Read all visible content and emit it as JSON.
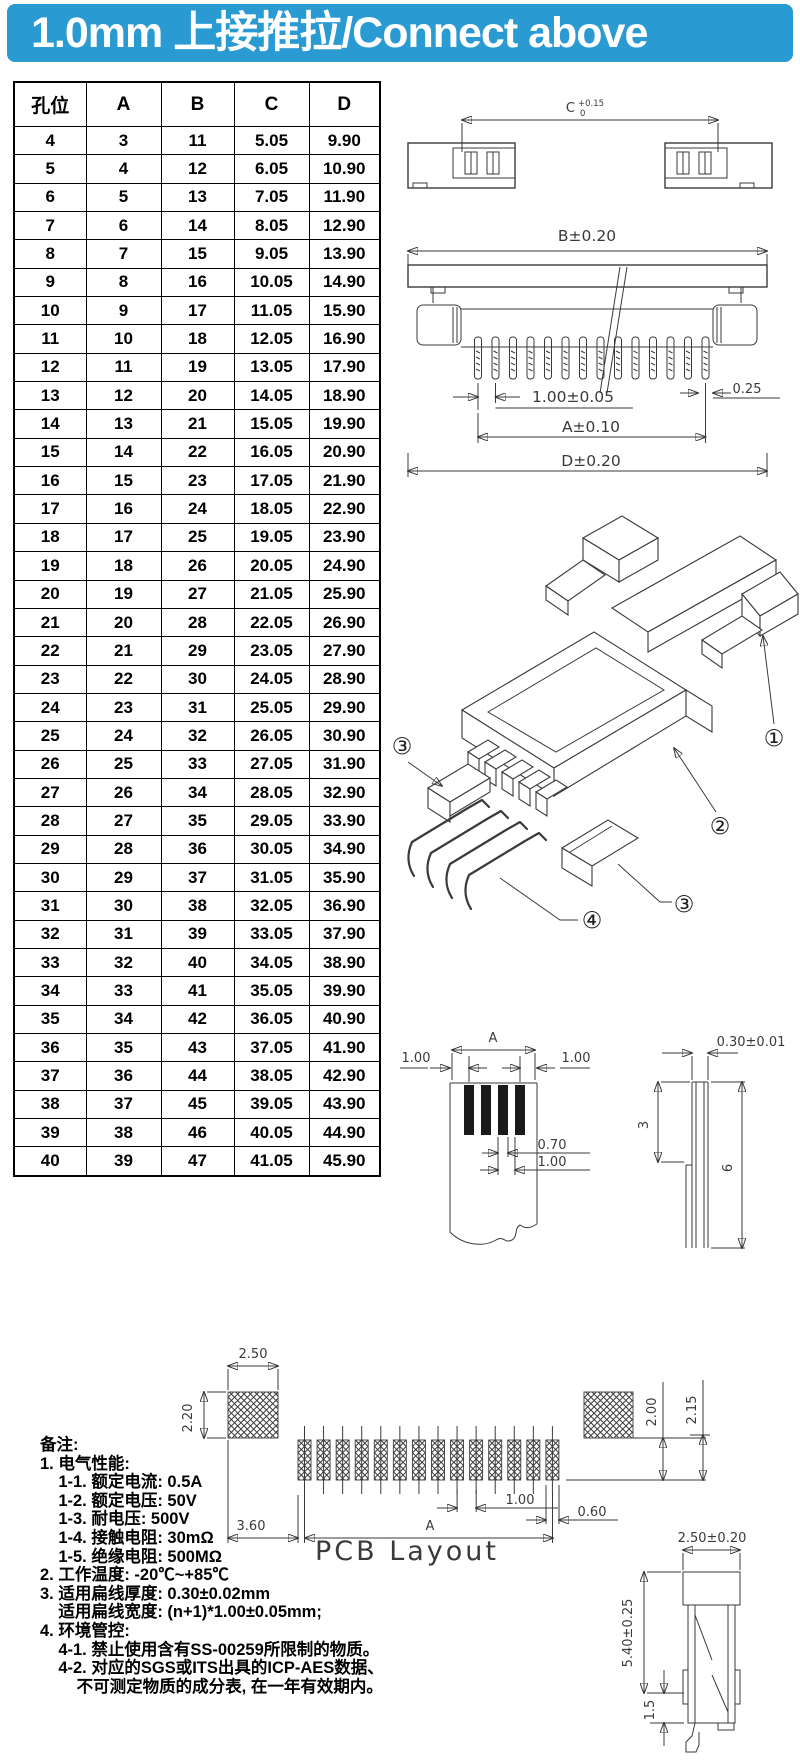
{
  "header": {
    "title": "1.0mm 上接推拉/Connect above"
  },
  "colors": {
    "banner_bg": "#2A9AD2",
    "banner_fg": "#ffffff",
    "line": "#3a3a3a"
  },
  "table": {
    "headers": [
      "孔位",
      "A",
      "B",
      "C",
      "D"
    ],
    "rows": [
      [
        "4",
        "3",
        "11",
        "5.05",
        "9.90"
      ],
      [
        "5",
        "4",
        "12",
        "6.05",
        "10.90"
      ],
      [
        "6",
        "5",
        "13",
        "7.05",
        "11.90"
      ],
      [
        "7",
        "6",
        "14",
        "8.05",
        "12.90"
      ],
      [
        "8",
        "7",
        "15",
        "9.05",
        "13.90"
      ],
      [
        "9",
        "8",
        "16",
        "10.05",
        "14.90"
      ],
      [
        "10",
        "9",
        "17",
        "11.05",
        "15.90"
      ],
      [
        "11",
        "10",
        "18",
        "12.05",
        "16.90"
      ],
      [
        "12",
        "11",
        "19",
        "13.05",
        "17.90"
      ],
      [
        "13",
        "12",
        "20",
        "14.05",
        "18.90"
      ],
      [
        "14",
        "13",
        "21",
        "15.05",
        "19.90"
      ],
      [
        "15",
        "14",
        "22",
        "16.05",
        "20.90"
      ],
      [
        "16",
        "15",
        "23",
        "17.05",
        "21.90"
      ],
      [
        "17",
        "16",
        "24",
        "18.05",
        "22.90"
      ],
      [
        "18",
        "17",
        "25",
        "19.05",
        "23.90"
      ],
      [
        "19",
        "18",
        "26",
        "20.05",
        "24.90"
      ],
      [
        "20",
        "19",
        "27",
        "21.05",
        "25.90"
      ],
      [
        "21",
        "20",
        "28",
        "22.05",
        "26.90"
      ],
      [
        "22",
        "21",
        "29",
        "23.05",
        "27.90"
      ],
      [
        "23",
        "22",
        "30",
        "24.05",
        "28.90"
      ],
      [
        "24",
        "23",
        "31",
        "25.05",
        "29.90"
      ],
      [
        "25",
        "24",
        "32",
        "26.05",
        "30.90"
      ],
      [
        "26",
        "25",
        "33",
        "27.05",
        "31.90"
      ],
      [
        "27",
        "26",
        "34",
        "28.05",
        "32.90"
      ],
      [
        "28",
        "27",
        "35",
        "29.05",
        "33.90"
      ],
      [
        "29",
        "28",
        "36",
        "30.05",
        "34.90"
      ],
      [
        "30",
        "29",
        "37",
        "31.05",
        "35.90"
      ],
      [
        "31",
        "30",
        "38",
        "32.05",
        "36.90"
      ],
      [
        "32",
        "31",
        "39",
        "33.05",
        "37.90"
      ],
      [
        "33",
        "32",
        "40",
        "34.05",
        "38.90"
      ],
      [
        "34",
        "33",
        "41",
        "35.05",
        "39.90"
      ],
      [
        "35",
        "34",
        "42",
        "36.05",
        "40.90"
      ],
      [
        "36",
        "35",
        "43",
        "37.05",
        "41.90"
      ],
      [
        "37",
        "36",
        "44",
        "38.05",
        "42.90"
      ],
      [
        "38",
        "37",
        "45",
        "39.05",
        "43.90"
      ],
      [
        "39",
        "38",
        "46",
        "40.05",
        "44.90"
      ],
      [
        "40",
        "39",
        "47",
        "41.05",
        "45.90"
      ]
    ]
  },
  "drawings": {
    "top_view": {
      "dim_c_base": "C",
      "dim_c_tol_up": "+0.15",
      "dim_c_tol_dn": "0"
    },
    "front_view": {
      "dim_b": "B±0.20",
      "dim_pitch": "1.00±0.05",
      "dim_pin_w": "0.25",
      "dim_a": "A±0.10",
      "dim_d": "D±0.20"
    },
    "exploded": {
      "label_1": "①",
      "label_2": "②",
      "label_3a": "③",
      "label_3b": "③",
      "label_4": "④"
    },
    "ffc_front": {
      "dim_a": "A",
      "dim_margin_left": "1.00",
      "dim_margin_right": "1.00",
      "dim_cond_w": "0.70",
      "dim_pitch": "1.00"
    },
    "ffc_side": {
      "dim_thickness": "0.30±0.01",
      "dim_exposed": "3",
      "dim_total": "6"
    },
    "pcb": {
      "dim_pad_w": "2.50",
      "dim_pad_h": "2.20",
      "dim_edge": "3.60",
      "dim_a": "A",
      "dim_pitch": "1.00",
      "dim_last_w": "0.60",
      "dim_h1": "2.00",
      "dim_h2": "2.15",
      "label": "PCB Layout"
    },
    "side_view": {
      "dim_w": "2.50±0.20",
      "dim_h": "5.40±0.25",
      "dim_lead": "1.5"
    }
  },
  "notes": {
    "lines": [
      "备注:",
      "1. 电气性能:",
      "    1-1. 额定电流: 0.5A",
      "    1-2. 额定电压: 50V",
      "    1-3. 耐电压: 500V",
      "    1-4. 接触电阻: 30mΩ",
      "    1-5. 绝缘电阻: 500MΩ",
      "2. 工作温度: -20℃~+85℃",
      "3. 适用扁线厚度: 0.30±0.02mm",
      "    适用扁线宽度: (n+1)*1.00±0.05mm;",
      "4. 环境管控:",
      "    4-1. 禁止使用含有SS-00259所限制的物质。",
      "    4-2. 对应的SGS或ITS出具的ICP-AES数据、",
      "        不可测定物质的成分表, 在一年有效期内。"
    ]
  }
}
